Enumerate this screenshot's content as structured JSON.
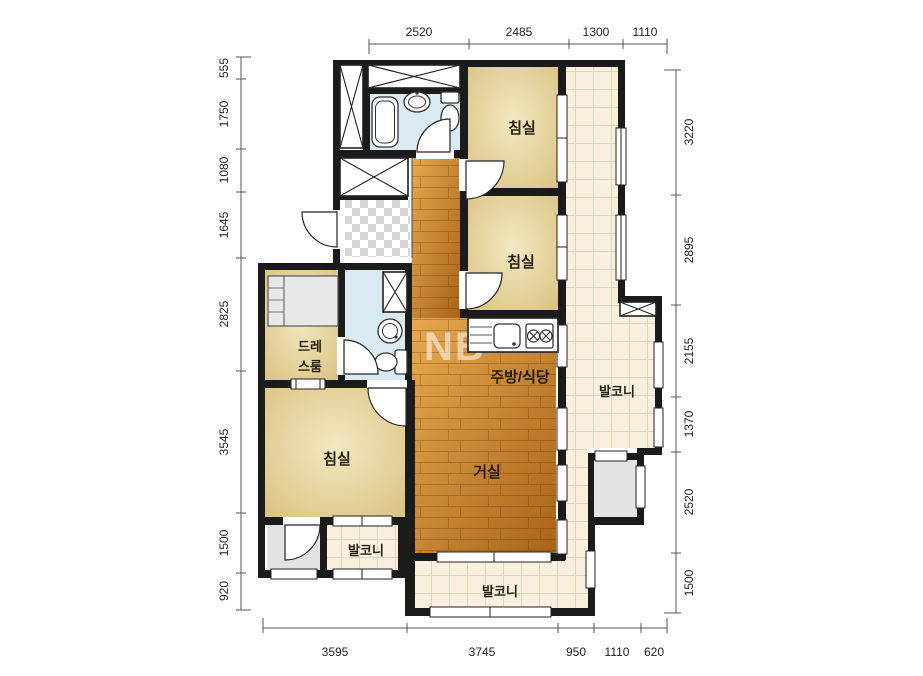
{
  "watermark": "NB",
  "rooms": {
    "bedroom_top": "침실",
    "bedroom_middle": "침실",
    "bedroom_left": "침실",
    "dressroom_line1": "드레",
    "dressroom_line2": "스룸",
    "kitchen_dining": "주방/식당",
    "living_room": "거실",
    "balcony_right": "발코니",
    "balcony_bottom": "발코니",
    "balcony_left": "발코니"
  },
  "dimensions": {
    "top": [
      "2520",
      "2485",
      "1300",
      "1110"
    ],
    "bottom": [
      "3595",
      "3745",
      "950",
      "1110",
      "620"
    ],
    "left": [
      "555",
      "1750",
      "1080",
      "1645",
      "2825",
      "3545",
      "1500",
      "920"
    ],
    "right": [
      "3220",
      "2895",
      "2155",
      "1370",
      "2520",
      "1500"
    ]
  },
  "colors": {
    "wall": "#1b1b1b",
    "wood_light": "#e6a94f",
    "wood_dark": "#a96417",
    "bedroom_floor": "#e9dcab",
    "tile": "#f9efdf",
    "bathroom": "#d9eaf2",
    "utility_gray": "#e3e3e3"
  }
}
